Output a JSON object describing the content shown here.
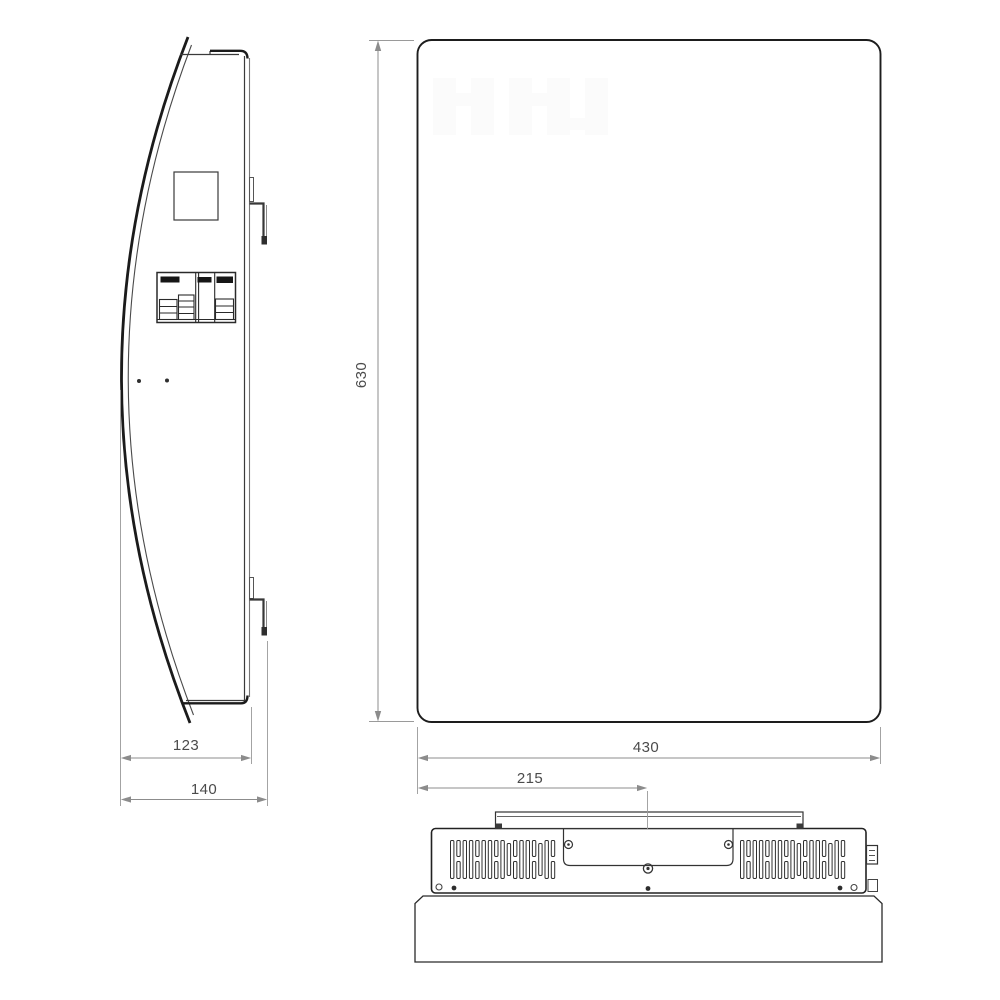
{
  "drawing": {
    "kind": "technical-dimension-drawing",
    "views": [
      "side-view",
      "front-view",
      "bottom-view"
    ],
    "dimensions": {
      "height": "630",
      "width": "430",
      "width_half": "215",
      "depth": "123",
      "depth_total": "140"
    },
    "colors": {
      "outline": "#1d1d1d",
      "thin_line": "#555555",
      "dimension_line": "#8c8c8c",
      "dimension_text": "#4b4b4b",
      "background": "#ffffff"
    }
  }
}
